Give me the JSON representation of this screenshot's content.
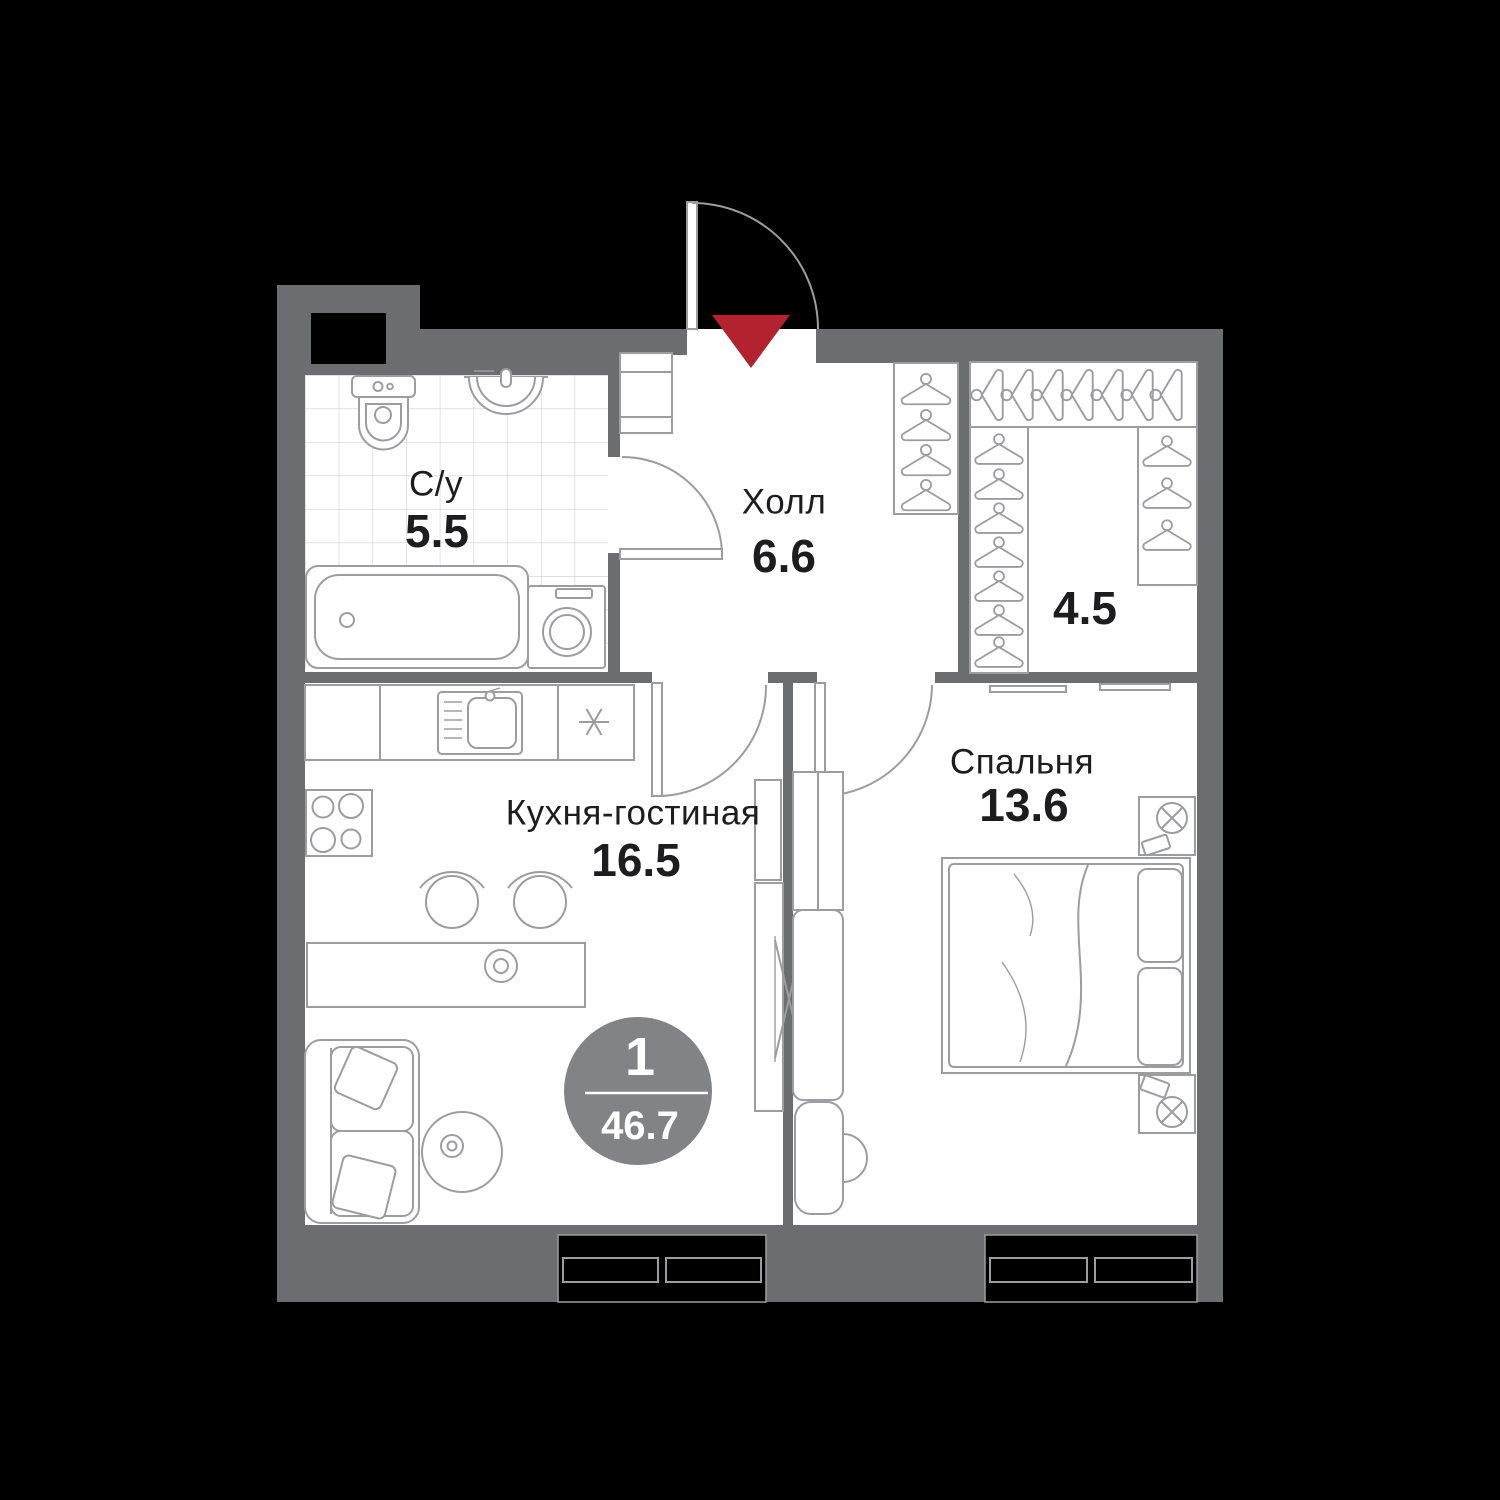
{
  "plan": {
    "rooms": [
      {
        "id": "bathroom",
        "name": "С/у",
        "area": "5.5"
      },
      {
        "id": "hall",
        "name": "Холл",
        "area": "6.6"
      },
      {
        "id": "wardrobe",
        "name": "",
        "area": "4.5"
      },
      {
        "id": "kitchen_living",
        "name": "Кухня-гостиная",
        "area": "16.5"
      },
      {
        "id": "bedroom",
        "name": "Спальня",
        "area": "13.6"
      }
    ],
    "badge": {
      "rooms_count": "1",
      "total_area": "46.7"
    },
    "icons": {
      "entrance_marker": "red-triangle-down",
      "appliance_asterisk": "✳"
    },
    "colors": {
      "background": "#000000",
      "walls": "#6c6d70",
      "floor": "#ffffff",
      "furniture_outline": "#9c9da0",
      "tile_line": "#cfd0d2",
      "text": "#1d1d1f",
      "badge_fill": "#828387",
      "badge_text": "#ffffff",
      "entrance_marker": "#b2222f"
    }
  }
}
